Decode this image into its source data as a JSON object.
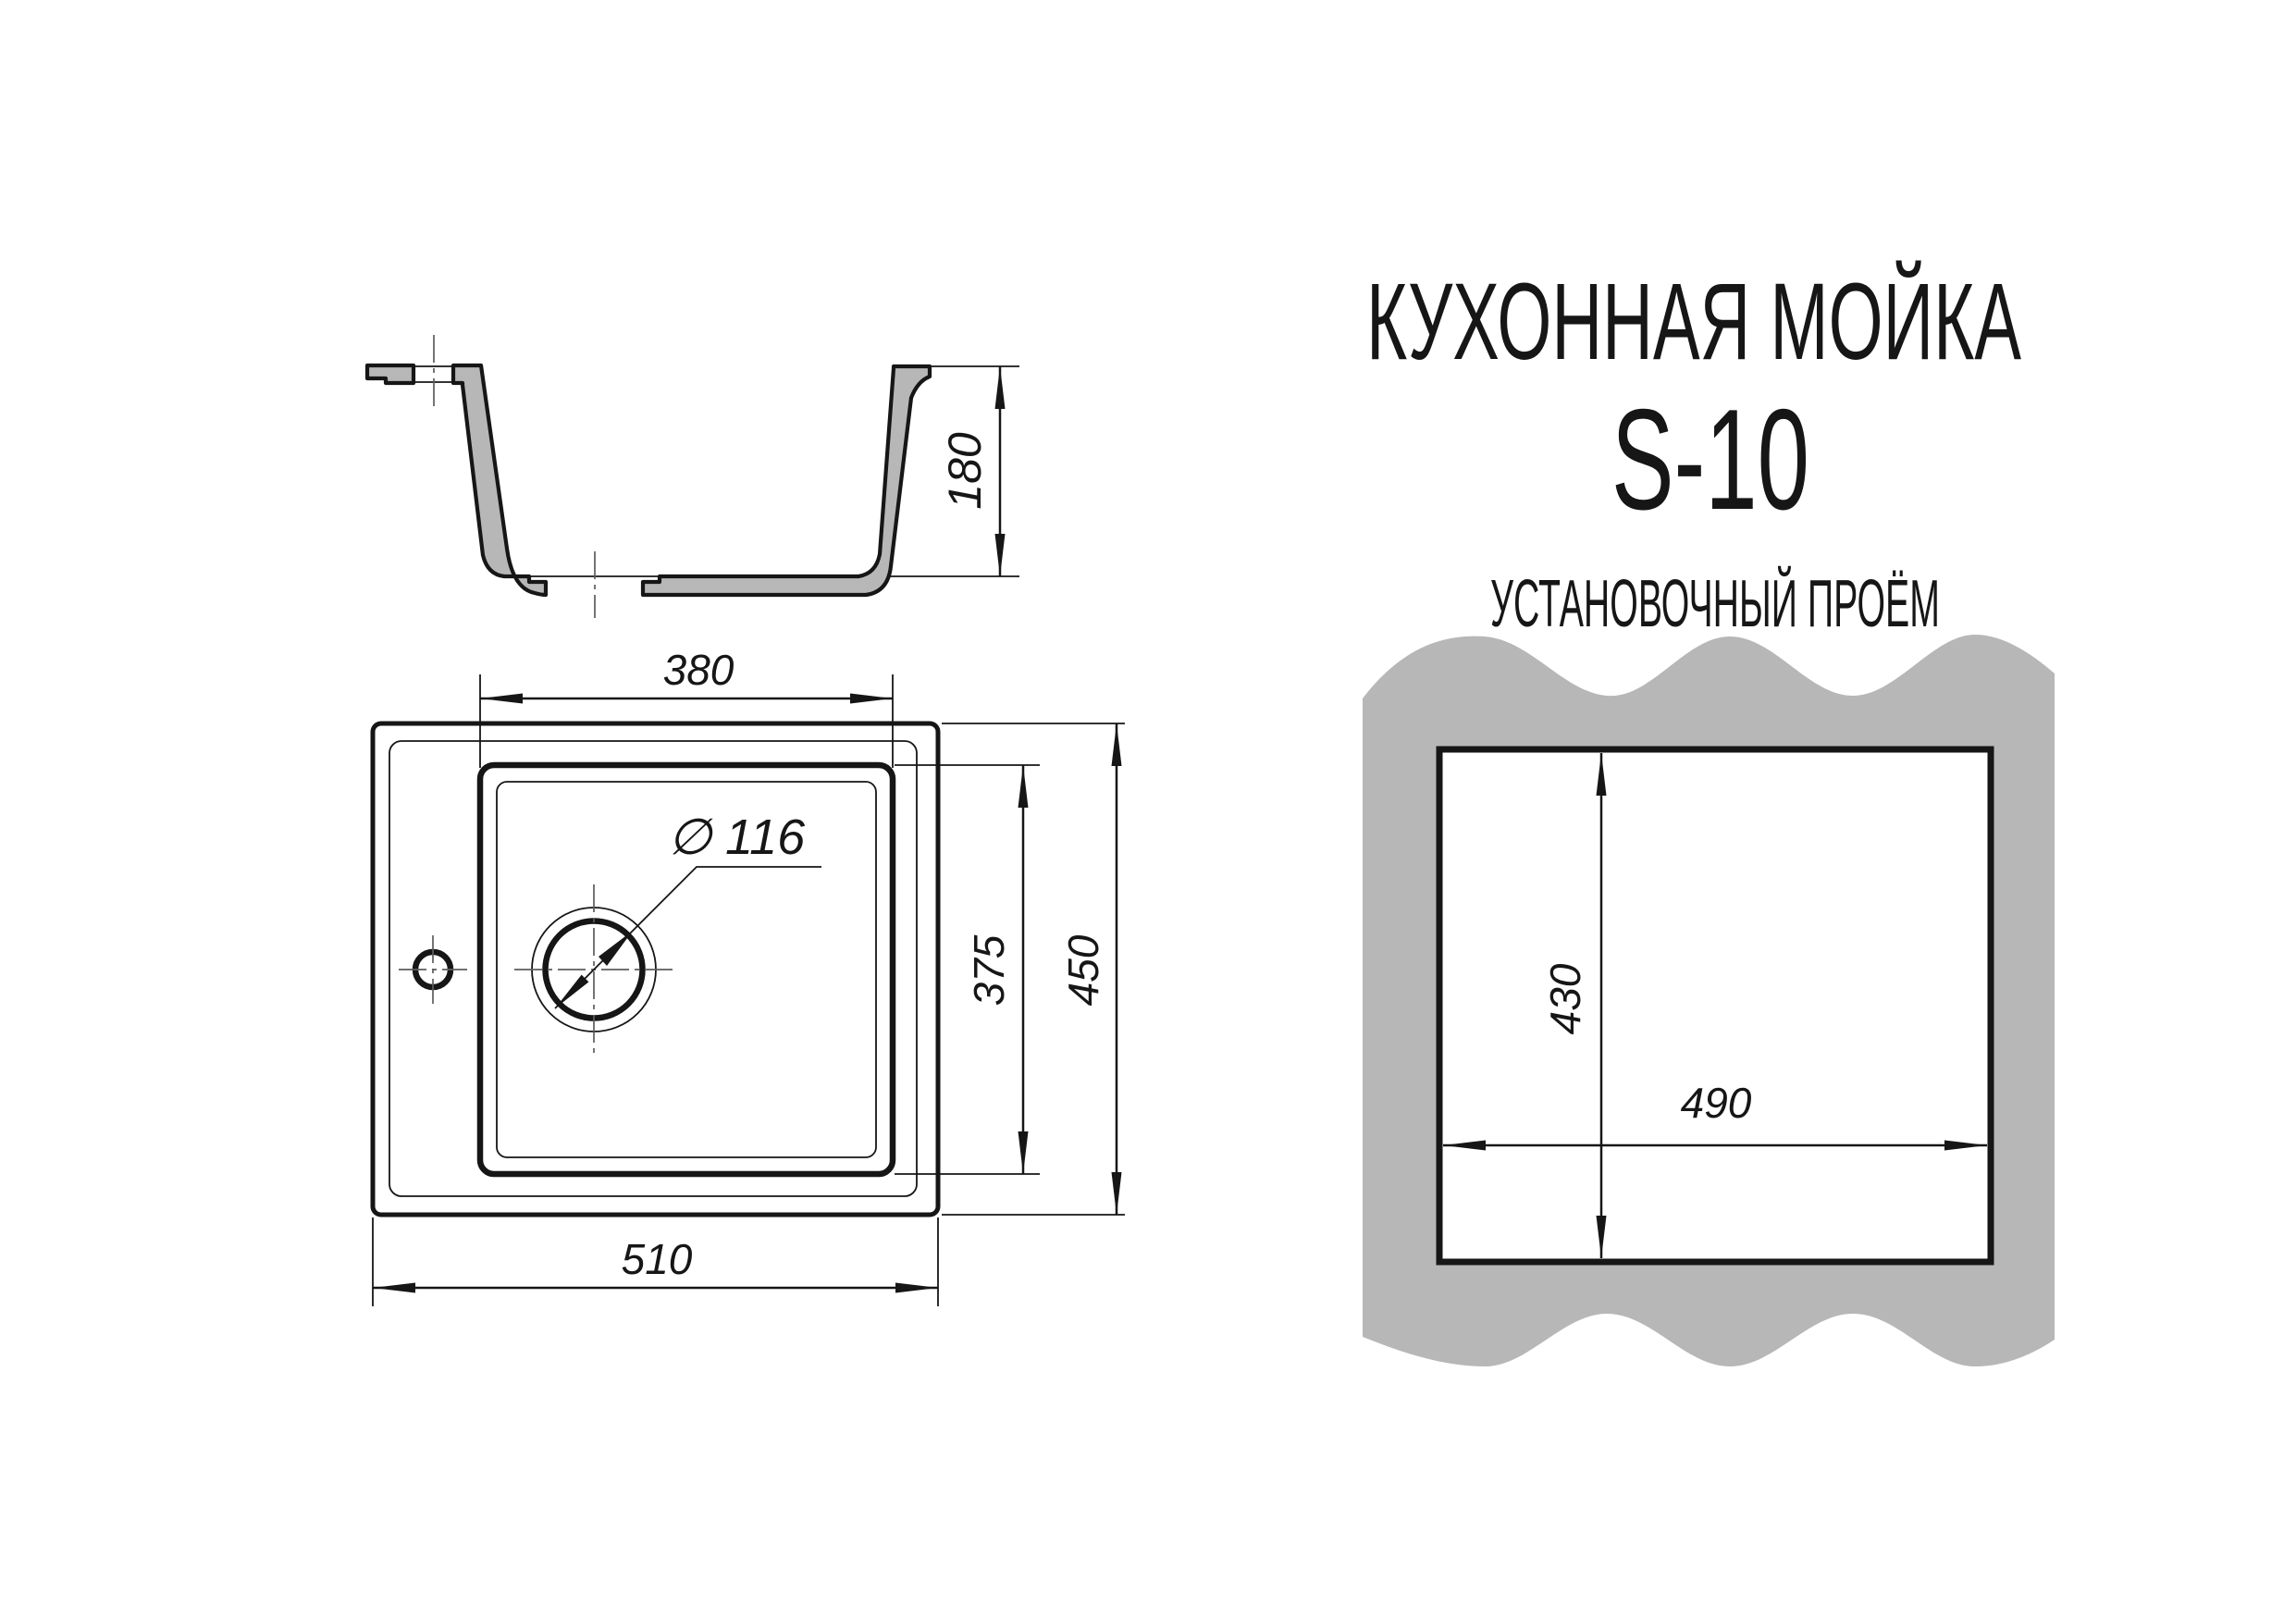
{
  "page": {
    "background": "#ffffff",
    "line_color": "#161616",
    "material_gray": "#b7b7b7"
  },
  "title": {
    "line1": "КУХОННАЯ МОЙКА",
    "line2": "S-10"
  },
  "section_view": {
    "depth_label": "180"
  },
  "plan_view": {
    "bowl_width_label": "380",
    "bowl_length_label": "375",
    "overall_length_label": "450",
    "overall_width_label": "510",
    "drain_diameter_label": "∅ 116"
  },
  "cutout_view": {
    "heading": "УСТАНОВОЧНЫЙ ПРОЁМ",
    "height_label": "430",
    "width_label": "490"
  }
}
